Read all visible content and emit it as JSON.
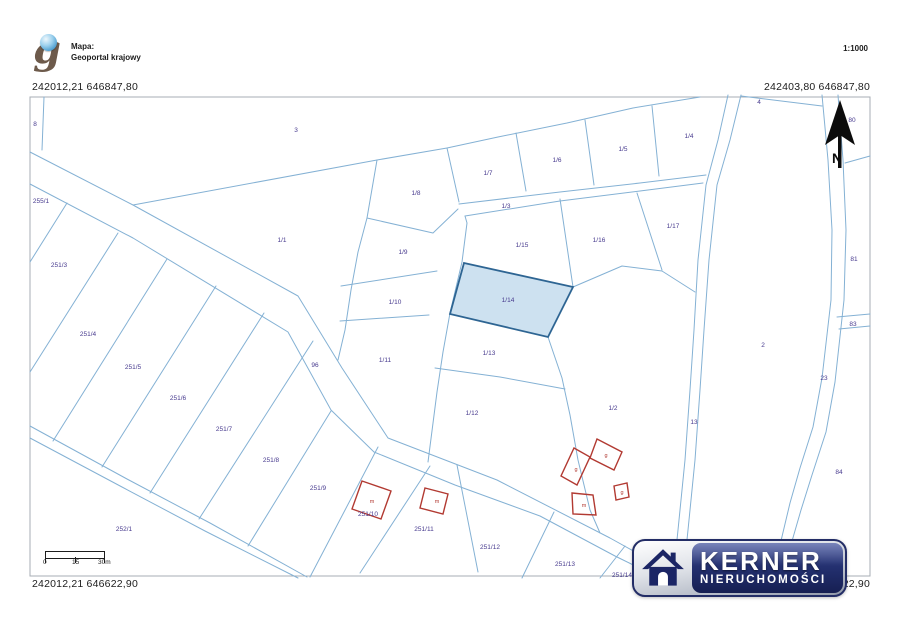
{
  "header": {
    "source_label": "Mapa:",
    "source_name": "Geoportal krajowy",
    "scale": "1:1000"
  },
  "coordinates": {
    "top_left": "242012,21 646847,80",
    "top_right": "242403,80 646847,80",
    "bottom_left": "242012,21 646622,90",
    "bottom_right": "242403,80 646622,90"
  },
  "north_arrow": {
    "label": "N"
  },
  "scale_bar": {
    "ticks": [
      "0",
      "15",
      "30m"
    ]
  },
  "map": {
    "line_color": "#84b1d4",
    "parcel_label_color": "#473a8e",
    "building_color": "#b23a32",
    "highlighted_parcel": {
      "label": "1/14",
      "fill": "#cde1f0",
      "stroke": "#2e6593"
    },
    "parcel_labels": [
      {
        "label": "8",
        "x": 35,
        "y": 126
      },
      {
        "label": "3",
        "x": 296,
        "y": 132
      },
      {
        "label": "255/1",
        "x": 41,
        "y": 203
      },
      {
        "label": "1/1",
        "x": 282,
        "y": 242
      },
      {
        "label": "251/3",
        "x": 59,
        "y": 267
      },
      {
        "label": "251/4",
        "x": 88,
        "y": 336
      },
      {
        "label": "251/5",
        "x": 133,
        "y": 369
      },
      {
        "label": "251/6",
        "x": 178,
        "y": 400
      },
      {
        "label": "251/7",
        "x": 224,
        "y": 431
      },
      {
        "label": "251/8",
        "x": 271,
        "y": 462
      },
      {
        "label": "251/9",
        "x": 318,
        "y": 490
      },
      {
        "label": "252/1",
        "x": 124,
        "y": 531
      },
      {
        "label": "251/10",
        "x": 368,
        "y": 516
      },
      {
        "label": "251/11",
        "x": 424,
        "y": 531
      },
      {
        "label": "251/12",
        "x": 490,
        "y": 549
      },
      {
        "label": "251/13",
        "x": 565,
        "y": 566
      },
      {
        "label": "251/14",
        "x": 622,
        "y": 577
      },
      {
        "label": "96",
        "x": 315,
        "y": 367
      },
      {
        "label": "1/8",
        "x": 416,
        "y": 195
      },
      {
        "label": "1/9",
        "x": 403,
        "y": 254
      },
      {
        "label": "1/10",
        "x": 395,
        "y": 304
      },
      {
        "label": "1/11",
        "x": 385,
        "y": 362
      },
      {
        "label": "1/7",
        "x": 488,
        "y": 175
      },
      {
        "label": "1/6",
        "x": 557,
        "y": 162
      },
      {
        "label": "1/5",
        "x": 623,
        "y": 151
      },
      {
        "label": "1/4",
        "x": 689,
        "y": 138
      },
      {
        "label": "1/3",
        "x": 506,
        "y": 208
      },
      {
        "label": "1/15",
        "x": 522,
        "y": 247
      },
      {
        "label": "1/16",
        "x": 599,
        "y": 242
      },
      {
        "label": "1/17",
        "x": 673,
        "y": 228
      },
      {
        "label": "1/14",
        "x": 508,
        "y": 302
      },
      {
        "label": "1/13",
        "x": 489,
        "y": 355
      },
      {
        "label": "1/12",
        "x": 472,
        "y": 415
      },
      {
        "label": "1/2",
        "x": 613,
        "y": 410
      },
      {
        "label": "13",
        "x": 694,
        "y": 424
      },
      {
        "label": "2",
        "x": 763,
        "y": 347
      },
      {
        "label": "23",
        "x": 824,
        "y": 380
      },
      {
        "label": "4",
        "x": 759,
        "y": 104
      },
      {
        "label": "80",
        "x": 852,
        "y": 122
      },
      {
        "label": "81",
        "x": 854,
        "y": 261
      },
      {
        "label": "83",
        "x": 853,
        "y": 326
      },
      {
        "label": "84",
        "x": 839,
        "y": 474
      }
    ],
    "building_labels": [
      {
        "label": "g",
        "x": 606,
        "y": 457
      },
      {
        "label": "g",
        "x": 576,
        "y": 471
      },
      {
        "label": "g",
        "x": 622,
        "y": 494
      },
      {
        "label": "m",
        "x": 584,
        "y": 507
      },
      {
        "label": "m",
        "x": 372,
        "y": 503
      },
      {
        "label": "m",
        "x": 437,
        "y": 503
      }
    ]
  },
  "logo": {
    "brand": "KERNER",
    "subtitle": "NIERUCHOMOŚCI",
    "panel_color": "#253273"
  }
}
